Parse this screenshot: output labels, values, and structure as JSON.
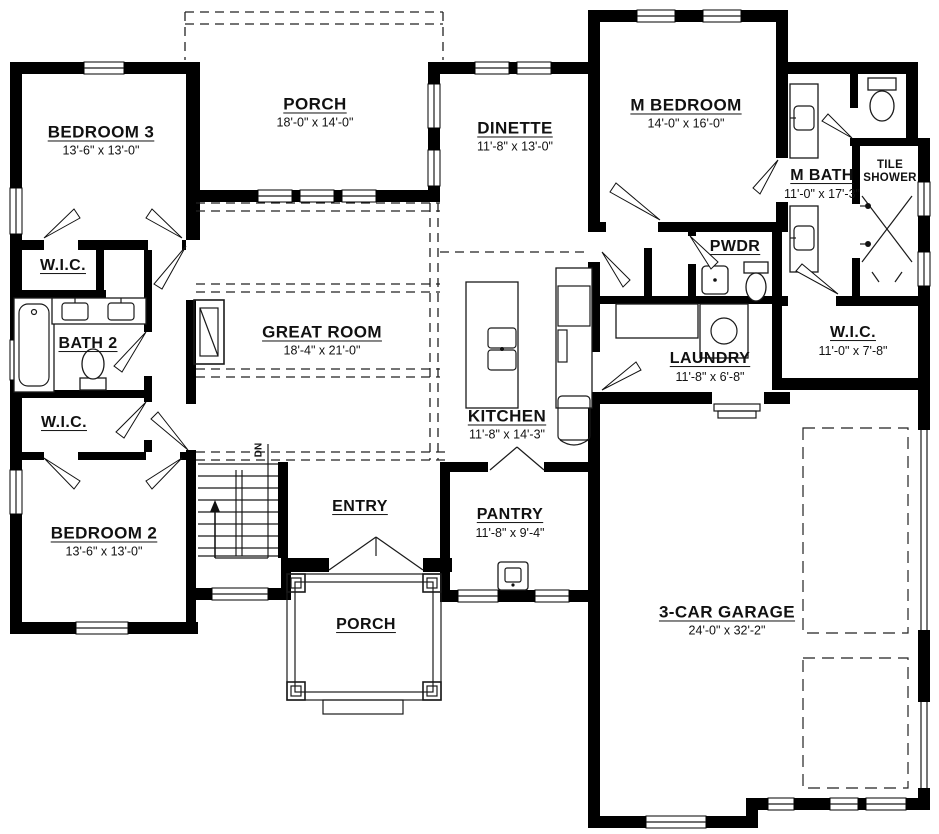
{
  "rooms": {
    "bedroom3": {
      "label": "BEDROOM 3",
      "dims": "13'-6\" x 13'-0\""
    },
    "porch_top": {
      "label": "PORCH",
      "dims": "18'-0\" x 14'-0\""
    },
    "dinette": {
      "label": "DINETTE",
      "dims": "11'-8\" x 13'-0\""
    },
    "m_bedroom": {
      "label": "M BEDROOM",
      "dims": "14'-0\" x 16'-0\""
    },
    "m_bath": {
      "label": "M BATH",
      "dims": "11'-0\" x 17'-3\""
    },
    "tile_shower": {
      "label": "TILE SHOWER",
      "dims": ""
    },
    "wic_bedroom3": {
      "label": "W.I.C.",
      "dims": ""
    },
    "bath2": {
      "label": "BATH 2",
      "dims": ""
    },
    "wic_bedroom2": {
      "label": "W.I.C.",
      "dims": ""
    },
    "great_room": {
      "label": "GREAT ROOM",
      "dims": "18'-4\" x 21'-0\""
    },
    "pwdr": {
      "label": "PWDR",
      "dims": ""
    },
    "laundry": {
      "label": "LAUNDRY",
      "dims": "11'-8\" x 6'-8\""
    },
    "wic_master": {
      "label": "W.I.C.",
      "dims": "11'-0\" x 7'-8\""
    },
    "kitchen": {
      "label": "KITCHEN",
      "dims": "11'-8\" x 14'-3\""
    },
    "bedroom2": {
      "label": "BEDROOM 2",
      "dims": "13'-6\" x 13'-0\""
    },
    "entry": {
      "label": "ENTRY",
      "dims": ""
    },
    "pantry": {
      "label": "PANTRY",
      "dims": "11'-8\" x 9'-4\""
    },
    "porch_bottom": {
      "label": "PORCH",
      "dims": ""
    },
    "garage": {
      "label": "3-CAR GARAGE",
      "dims": "24'-0\" x 32'-2\""
    }
  },
  "annotations": {
    "stairs_direction": "DN"
  },
  "palette": {
    "wall": "#000000",
    "line": "#1a1a1a",
    "background": "#ffffff"
  }
}
